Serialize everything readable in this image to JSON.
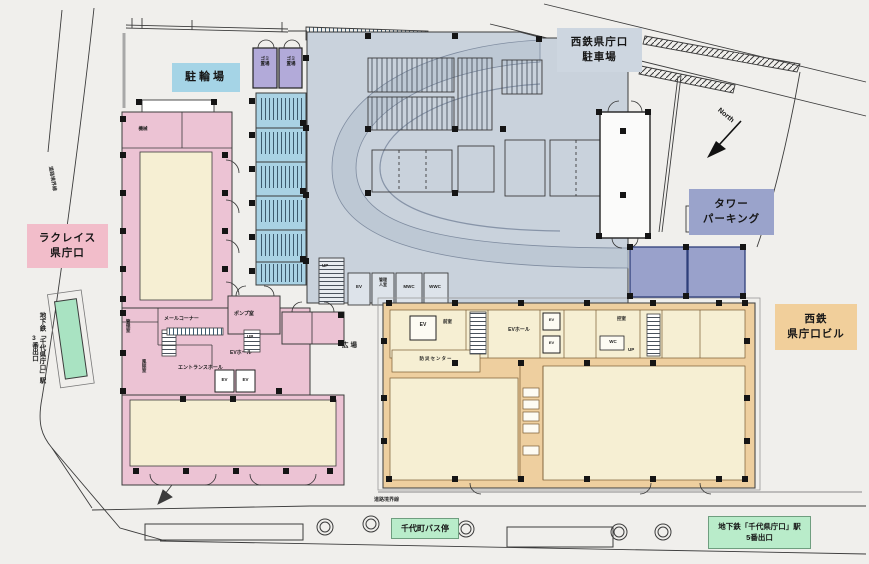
{
  "labels": {
    "bicycle_parking": "駐輪場",
    "nishitetsu_parking_l1": "西鉄県庁口",
    "nishitetsu_parking_l2": "駐車場",
    "tower_parking_l1": "タワー",
    "tower_parking_l2": "パーキング",
    "nishitetsu_bldg_l1": "西鉄",
    "nishitetsu_bldg_l2": "県庁口ビル",
    "lacreis_l1": "ラクレイス",
    "lacreis_l2": "県庁口",
    "bus_stop": "千代町バス停",
    "subway5_l1": "地下鉄「千代県庁口」駅",
    "subway5_l2": "5番出口",
    "subway3_l1": "地下鉄「千代県庁口」駅",
    "subway3_l2": "3番出口",
    "north": "North",
    "road_boundary": "道路境界線",
    "plaza": "広場"
  },
  "rooms": {
    "garbage_l1": "ゴミ",
    "garbage_l2": "置場",
    "machine": "機械",
    "kanri": "管理室",
    "fujo": "風除室",
    "mail_corner": "メールコーナー",
    "pump": "ポンプ室",
    "up": "UP",
    "ev": "EV",
    "ev_hall": "EVホール",
    "entrance_hall": "エントランスホール",
    "kanrinin_l1": "管理",
    "kanrinin_l2": "人室",
    "mwc": "MWC",
    "wwc": "WWC",
    "zenshitsu": "前室",
    "bousai": "防災センター",
    "hikae": "控室",
    "wc": "WC"
  },
  "colors": {
    "background": "#f0efec",
    "parking_structure": "#c9d2dc",
    "ramp_band": "#bdc8d4",
    "bicycle_strip": "#a9d2e4",
    "garbage_room": "#b2aad9",
    "pink_building": "#ecc3d4",
    "cream_floor": "#f6efd3",
    "orange_building": "#eecf9f",
    "tower_parking": "#99a1cb",
    "green_exit": "#a9e3c2",
    "label_blue": "#a5d4e6",
    "label_gray": "#cdd6e0",
    "label_purple": "#9aa3cb",
    "label_orange": "#f1cf9b",
    "label_pink": "#f2bdca",
    "label_green": "#b9ecca",
    "line": "#3c3c3c"
  }
}
